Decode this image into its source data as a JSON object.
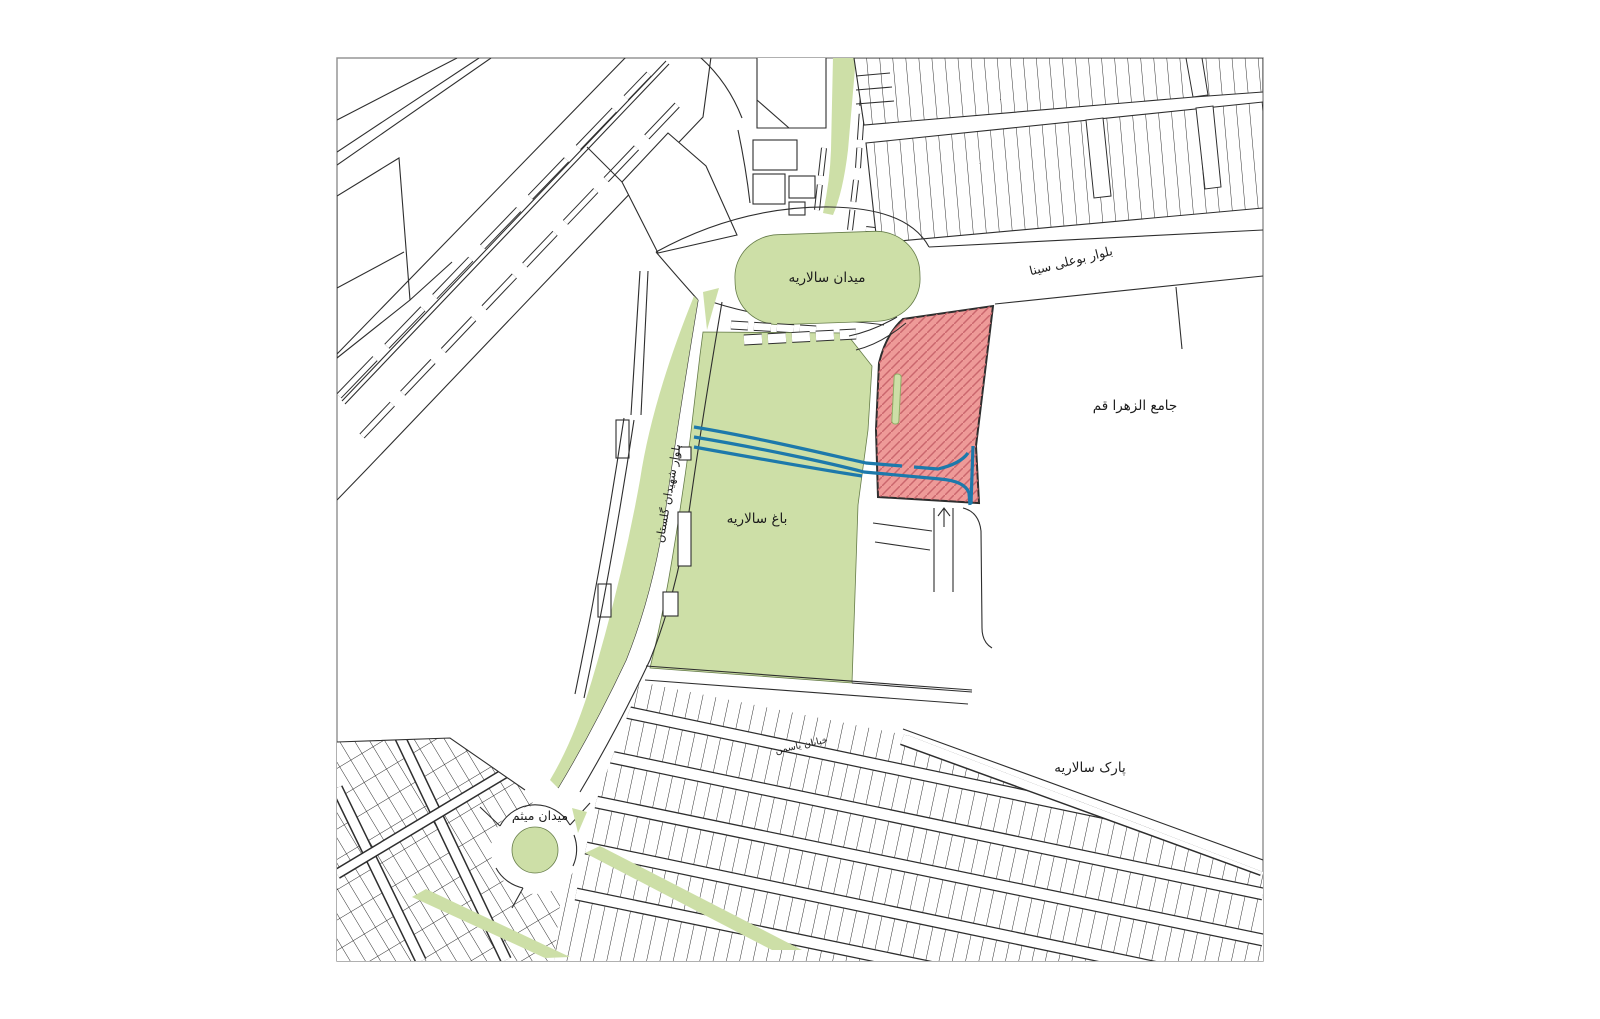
{
  "map": {
    "type": "site-plan",
    "labels": {
      "salariyeh_square": "میدان سالاریه",
      "bu_ali_sina_blvd": "بلوار بوعلی سینا",
      "jamiat_al_zahra": "جامع الزهرا قم",
      "salariyeh_garden": "باغ سالاریه",
      "shahidan_golestan_blvd": "بلوار شهیدان گلستان",
      "yasaman_street": "خیابان یاسمن",
      "salariyeh_park": "پارک سالاریه",
      "meysam_square": "میدان میثم"
    },
    "icons": {
      "entry_arrow": "↑"
    },
    "colors": {
      "green": "#cddfa7",
      "green_dark": "#8fae66",
      "site_fill": "#ee9a98",
      "site_hatch": "#ca666d",
      "water": "#1d79ab",
      "line": "#2e2e2e",
      "frame": "#8e8e8e",
      "label": "#1c1c1c"
    }
  }
}
